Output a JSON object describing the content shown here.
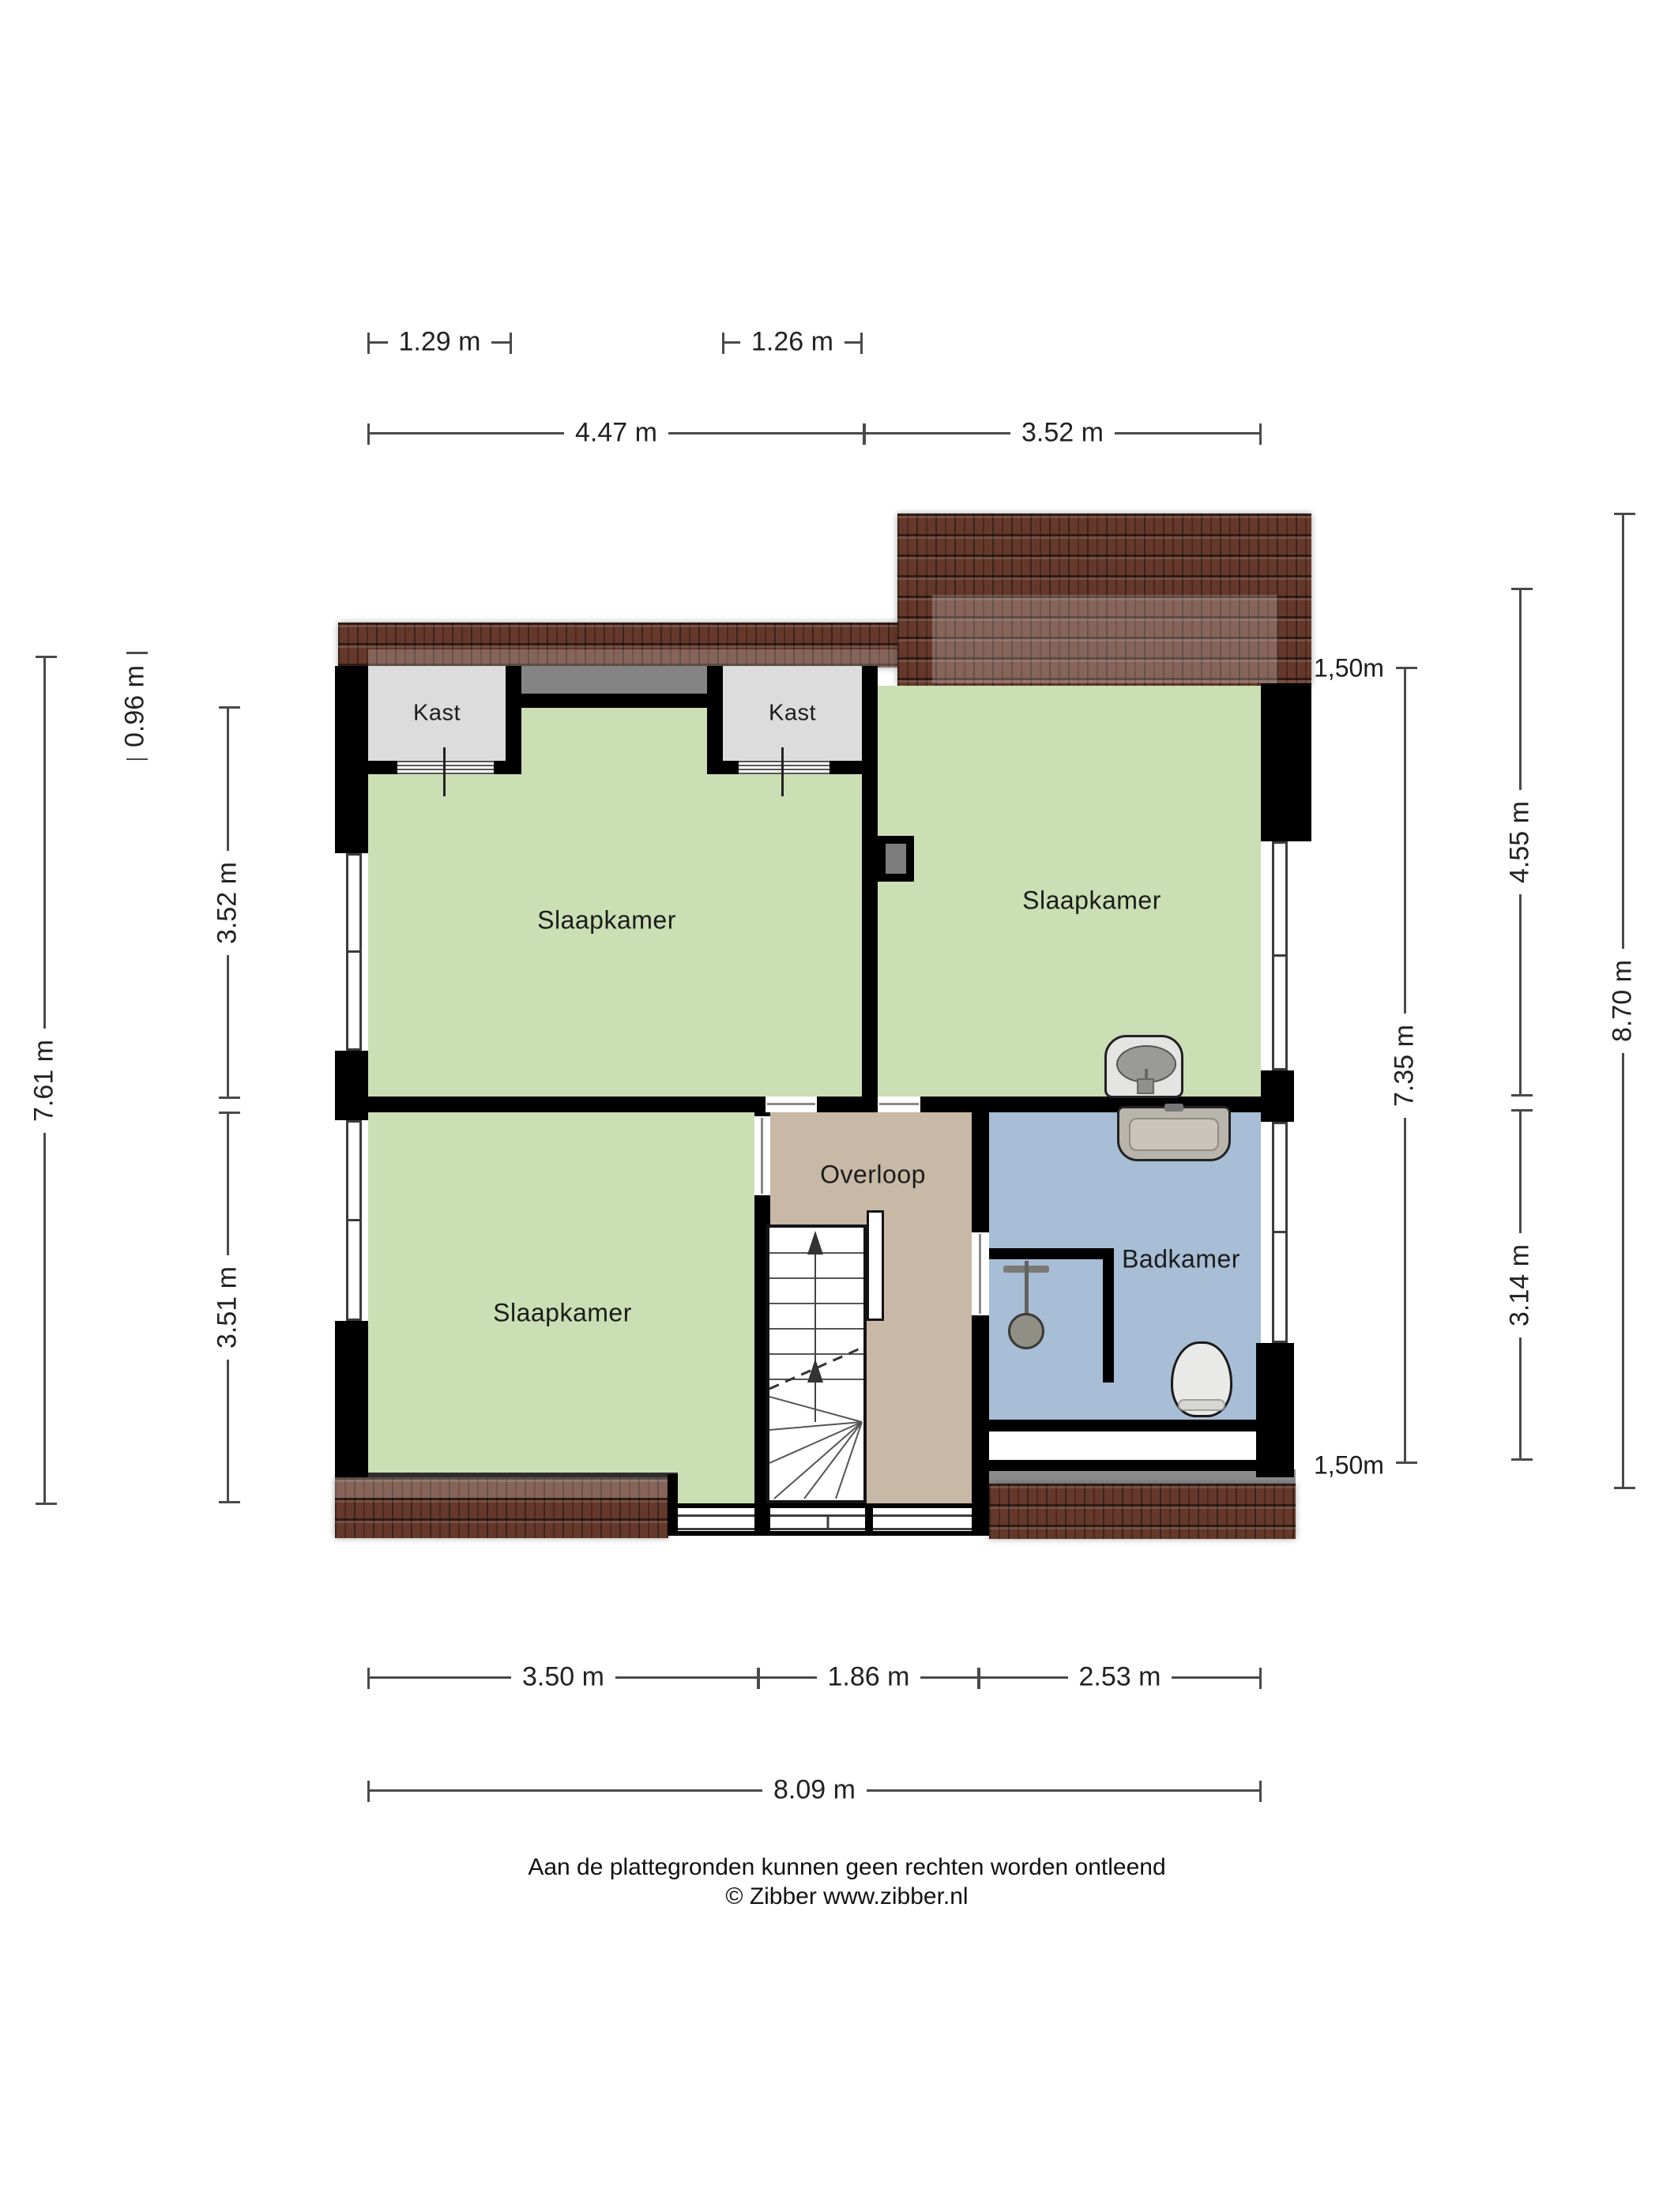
{
  "title": "Eerste verdieping plattegrond",
  "rooms": {
    "closet1": "Kast",
    "closet2": "Kast",
    "bedroom_top_left": "Slaapkamer",
    "bedroom_top_right": "Slaapkamer",
    "bedroom_bottom_left": "Slaapkamer",
    "landing": "Overloop",
    "bathroom": "Badkamer"
  },
  "knee_wall_labels": {
    "top": "1,50m",
    "bottom": "1,50m"
  },
  "dimensions": {
    "top": [
      {
        "label": "1.29 m"
      },
      {
        "label": "1.26 m"
      },
      {
        "label": "4.47 m"
      },
      {
        "label": "3.52 m"
      }
    ],
    "left": [
      {
        "label": "0.96 m"
      },
      {
        "label": "3.52 m"
      },
      {
        "label": "3.51 m"
      },
      {
        "label": "7.61 m"
      }
    ],
    "right": [
      {
        "label": "7.35 m"
      },
      {
        "label": "4.55 m"
      },
      {
        "label": "3.14 m"
      },
      {
        "label": "8.70 m"
      }
    ],
    "bottom": [
      {
        "label": "3.50 m"
      },
      {
        "label": "1.86 m"
      },
      {
        "label": "2.53 m"
      },
      {
        "label": "8.09 m"
      }
    ]
  },
  "footer": {
    "line1": "Aan de plattegronden kunnen geen rechten worden ontleend",
    "line2": "© Zibber www.zibber.nl"
  },
  "colors": {
    "room_green": "#cbdfb4",
    "room_gray": "#dcdcdc",
    "void_gray": "#848484",
    "landing_tan": "#c7b9a5",
    "bath_blue": "#a8bdd6",
    "wall_black": "#000000",
    "roof_brown": "#64392b",
    "shadow_gray": "#8c8c8c",
    "dim_line": "#4a4a4a"
  }
}
